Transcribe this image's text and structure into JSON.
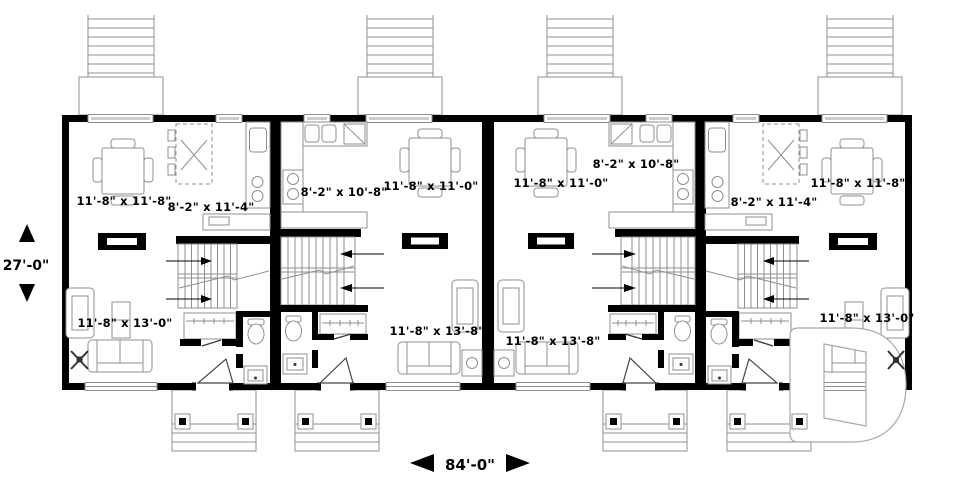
{
  "plan_dimensions": {
    "height_label": "27'-0\"",
    "width_label": "84'-0\""
  },
  "units": [
    {
      "name": "unit-1",
      "dining_label": "11'-8\" x 11'-8\"",
      "kitchen_label": "8'-2\" x 11'-4\"",
      "living_label": "11'-8\" x 13'-0\""
    },
    {
      "name": "unit-2",
      "kitchen_label": "8'-2\" x 10'-8\"",
      "dining_label": "11'-8\" x 11'-0\"",
      "living_label": "11'-8\" x 13'-8\""
    },
    {
      "name": "unit-3",
      "dining_label": "11'-8\" x 11'-0\"",
      "kitchen_label": "8'-2\" x 10'-8\"",
      "living_label": "11'-8\" x 13'-8\""
    },
    {
      "name": "unit-4",
      "kitchen_label": "8'-2\" x 11'-4\"",
      "dining_label": "11'-8\" x 11'-8\"",
      "living_label": "11'-8\" x 13'-0\""
    }
  ],
  "icons": {
    "up_arrow": "▲",
    "down_arrow": "▼",
    "left_arrow": "◀",
    "right_arrow": "▶",
    "watermark_letter": "D"
  },
  "colors": {
    "wall": "#000000",
    "drawing_line": "#8f8f8f",
    "window_fill": "#cccccc",
    "text": "#000000",
    "watermark_outline": "#a8a8a8",
    "background": "#ffffff"
  }
}
